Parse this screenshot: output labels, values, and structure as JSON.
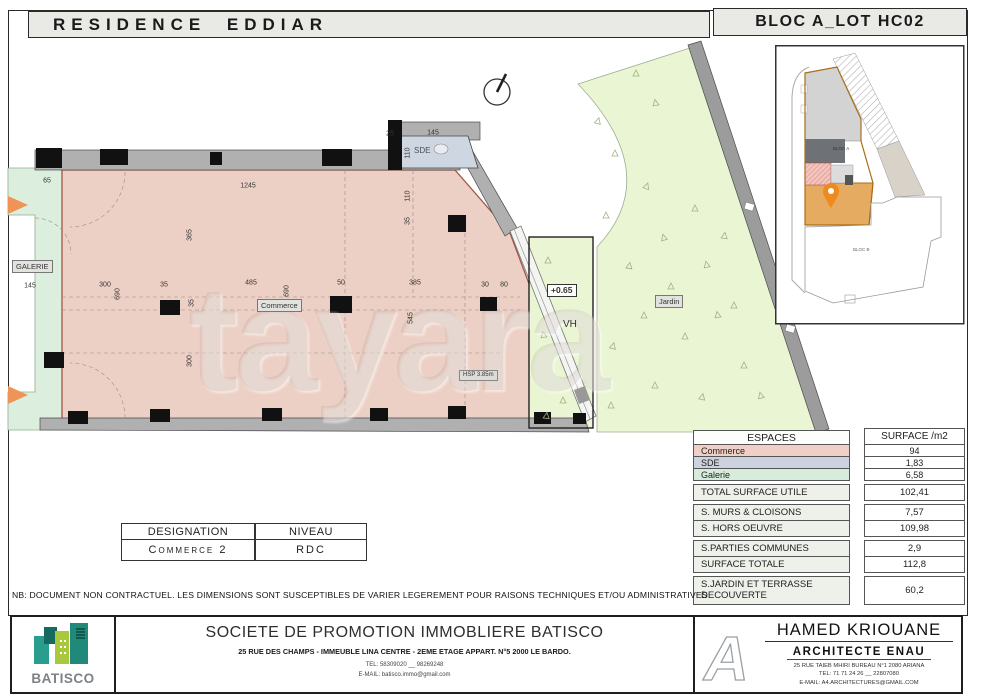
{
  "header": {
    "project_title": "RESIDENCE EDDIAR",
    "bloc_title": "BLOC A_LOT HC02"
  },
  "watermark": "tayara",
  "plan": {
    "room_labels": {
      "galerie": "GALERIE",
      "commerce": "Commerce",
      "sde": "SDE",
      "jardin": "Jardin",
      "vh": "VH",
      "level": "+0.65",
      "hsp": "HSP  3.85m"
    },
    "inset_labels": {
      "bloc_a": "BLOC A",
      "bloc_b": "BLOC B"
    },
    "dims": [
      {
        "t": "65",
        "x": 47,
        "y": 181
      },
      {
        "t": "1245",
        "x": 248,
        "y": 186
      },
      {
        "t": "25",
        "x": 390,
        "y": 134
      },
      {
        "t": "145",
        "x": 433,
        "y": 133
      },
      {
        "t": "110",
        "x": 408,
        "y": 153,
        "v": 1
      },
      {
        "t": "110",
        "x": 408,
        "y": 196,
        "v": 1
      },
      {
        "t": "35",
        "x": 408,
        "y": 221,
        "v": 1
      },
      {
        "t": "145",
        "x": 30,
        "y": 286
      },
      {
        "t": "300",
        "x": 105,
        "y": 285
      },
      {
        "t": "35",
        "x": 164,
        "y": 285
      },
      {
        "t": "485",
        "x": 251,
        "y": 283
      },
      {
        "t": "50",
        "x": 341,
        "y": 283
      },
      {
        "t": "385",
        "x": 415,
        "y": 283
      },
      {
        "t": "30",
        "x": 485,
        "y": 285
      },
      {
        "t": "80",
        "x": 504,
        "y": 285
      },
      {
        "t": "690",
        "x": 118,
        "y": 294,
        "v": 1
      },
      {
        "t": "690",
        "x": 287,
        "y": 291,
        "v": 1
      },
      {
        "t": "545",
        "x": 411,
        "y": 318,
        "v": 1
      },
      {
        "t": "365",
        "x": 190,
        "y": 235,
        "v": 1
      },
      {
        "t": "35",
        "x": 192,
        "y": 303,
        "v": 1
      },
      {
        "t": "300",
        "x": 190,
        "y": 361,
        "v": 1
      }
    ]
  },
  "tables": {
    "espaces": {
      "col1_header": "ESPACES",
      "col2_header": "SURFACE /m2",
      "rows": [
        {
          "label": "Commerce",
          "value": "94",
          "color": "#f0d0c6"
        },
        {
          "label": "SDE",
          "value": "1,83",
          "color": "#ccd3de"
        },
        {
          "label": "Galerie",
          "value": "6,58",
          "color": "#d8ecdb"
        }
      ],
      "total_row": {
        "label": "TOTAL SURFACE UTILE",
        "value": "102,41"
      },
      "detail_rows": [
        {
          "label": "S. MURS & CLOISONS",
          "value": "7,57"
        },
        {
          "label": "S. HORS OEUVRE",
          "value": "109,98"
        },
        {
          "label": "S.PARTIES COMMUNES",
          "value": "2,9"
        },
        {
          "label": "SURFACE TOTALE",
          "value": "112,8"
        },
        {
          "label": "S.JARDIN ET TERRASSE DECOUVERTE",
          "value": "60,2"
        }
      ]
    },
    "designation": {
      "col1_header": "DESIGNATION",
      "col2_header": "NIVEAU",
      "designation": "Commerce 2",
      "niveau": "RDC"
    }
  },
  "note": "NB: DOCUMENT NON CONTRACTUEL. LES DIMENSIONS SONT SUSCEPTIBLES DE VARIER LEGEREMENT POUR RAISONS TECHNIQUES ET/OU ADMINISTRATIVES",
  "footer": {
    "batisco": {
      "logo_text": "BATISCO",
      "company": "SOCIETE DE PROMOTION IMMOBLIERE BATISCO",
      "address": "25 RUE DES CHAMPS - IMMEUBLE LINA CENTRE - 2EME ETAGE APPART. N°5 2000 LE BARDO.",
      "tel": "TEL: 58309020 __ 98269248",
      "email": "E-MAIL: batisco.immo@gmail.com"
    },
    "architect": {
      "name": "HAMED KRIOUANE",
      "title": "ARCHITECTE  ENAU",
      "address": "25 RUE TAIEB MHIRI BUREAU N°1  2080    ARIANA",
      "tel": "TEL: 71 71 24 26 __ 22807080",
      "email": "E-MAIL: A4.ARCHITECTURES@GMAIL.COM"
    }
  },
  "colors": {
    "commerce_fill": "#edd0c5",
    "jardin_fill": "#e9f5d3",
    "galerie_fill": "#dceede",
    "sde_fill": "#ced6e2",
    "wall_gray": "#b0b0b0",
    "accent_orange": "#ef9457",
    "inset_highlight": "#e5ab60"
  }
}
